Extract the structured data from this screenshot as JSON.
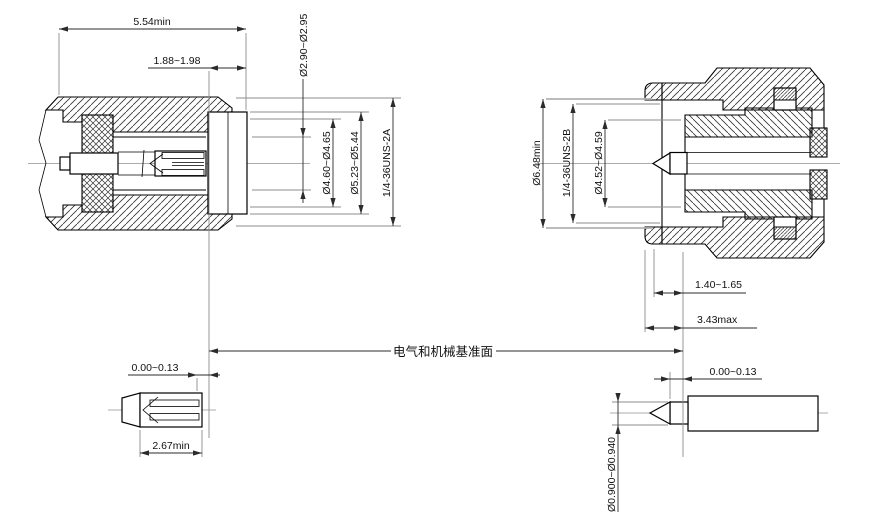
{
  "drawing": {
    "reference_plane_label": "电气和机械基准面",
    "left_view": {
      "dim_length": "5.54min",
      "dim_thread_length": "1.88~1.98",
      "dia_contact_bore": "Ø2.90~Ø2.95",
      "dia_insulator": "Ø4.60~Ø4.65",
      "dia_mating_bore": "Ø5.23~Ø5.44",
      "thread_spec": "1/4-36UNS-2A"
    },
    "right_view": {
      "dia_nut_bore": "Ø6.48min",
      "thread_spec": "1/4-36UNS-2B",
      "dia_outer_contact": "Ø4.52~Ø4.59",
      "dim_dielectric_offset": "1.40~1.65",
      "dim_nut_face_offset": "3.43max"
    },
    "left_detail": {
      "dim_contact_recess": "0.00~0.13",
      "dim_socket_depth": "2.67min"
    },
    "right_detail": {
      "dim_pin_recess": "0.00~0.13",
      "dia_pin": "Ø0.900~Ø0.940"
    },
    "colors": {
      "line": "#000000",
      "dimension": "#2b2b2b",
      "extension": "#8c8c8c",
      "background": "#ffffff"
    }
  }
}
